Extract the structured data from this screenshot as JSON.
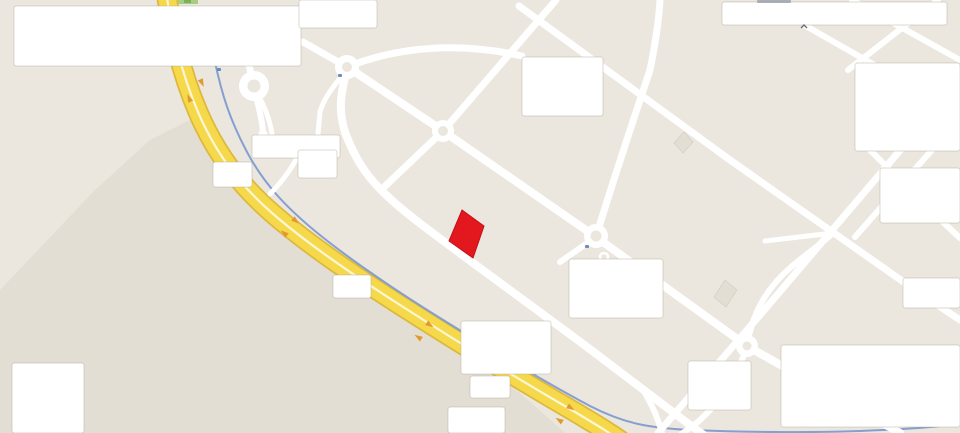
{
  "map": {
    "kind": "road-map-with-redacted-labels",
    "canvas": {
      "width": 960,
      "height": 433
    },
    "colors": {
      "background": "#ebe7de",
      "shade_zone": "rgba(208,201,186,0.30)",
      "road_white": "#ffffff",
      "highway_casing": "#dcb83e",
      "highway_fill": "#f6d94a",
      "highway_divider": "#fdf6d8",
      "arrow_orange": "#e2992f",
      "waterway_blue": "#7f9bd0",
      "building_red": "#e3171e",
      "building_red_stroke": "#c31016",
      "building_gray": "#e2ded4",
      "box_fill": "#ffffff",
      "box_edge": "rgba(175,168,150,0.45)",
      "poi_blue": "#5b7fbe",
      "fragment_green": "#a9cd80",
      "fragment_green_dark": "#7fae5d",
      "fragment_gray": "#9aa0ab"
    },
    "shade_polygon": "190,120 230,175 275,220 330,263 390,303 455,348 520,393 565,433 0,433 0,290 95,190 150,140",
    "highway": {
      "path": "M 166,-8 C 172,30 180,70 198,112 C 216,154 240,185 272,213 C 304,241 350,273 400,305 C 450,337 520,380 575,412 C 600,427 615,436 628,446",
      "casing_width": 21,
      "fill_width": 17.5,
      "divider_width": 2.2,
      "arrows": [
        {
          "x": 189,
          "y": 98,
          "angle": 246
        },
        {
          "x": 202,
          "y": 83,
          "angle": 66
        },
        {
          "x": 284,
          "y": 233,
          "angle": 220
        },
        {
          "x": 296,
          "y": 221,
          "angle": 40
        },
        {
          "x": 418,
          "y": 337,
          "angle": 213
        },
        {
          "x": 430,
          "y": 325,
          "angle": 33
        },
        {
          "x": 559,
          "y": 420,
          "angle": 213
        },
        {
          "x": 571,
          "y": 408,
          "angle": 33
        }
      ]
    },
    "waterway": {
      "path": "M 215,62 C 222,95 230,120 247,152 C 264,184 286,207 315,231 C 344,255 390,287 440,318 C 490,349 545,382 590,406 C 625,424 650,428 690,430 C 740,432 800,433 860,431 C 910,429 940,427 962,423",
      "width": 2
    },
    "roads": [
      {
        "id": "frontage",
        "width": 8,
        "d": "M 347,70 C 340,95 338,112 346,135 C 356,160 366,175 382,191 C 402,211 430,231 465,257 C 500,283 540,312 575,338 C 610,364 650,395 690,425 C 700,432 706,437 712,441"
      },
      {
        "id": "frontage-spur",
        "width": 6,
        "d": "M 645,393 C 652,405 658,418 662,433"
      },
      {
        "id": "avenue-b-c-d-e",
        "width": 8,
        "d": "M 349,68 L 443,131 L 596,237 L 747,346 L 900,433"
      },
      {
        "id": "cross-through-c",
        "width": 7,
        "d": "M 556,0 L 443,131 L 381,190"
      },
      {
        "id": "avenue-upper",
        "width": 7,
        "d": "M 519,6 L 730,160 L 915,290 L 960,320"
      },
      {
        "id": "cross-right-long",
        "width": 7,
        "d": "M 902,148 L 760,315 L 658,433"
      },
      {
        "id": "d-north",
        "width": 7,
        "d": "M 596,237 C 610,190 630,130 650,70 C 656,40 659,20 660,0"
      },
      {
        "id": "e-north",
        "width": 6,
        "d": "M 747,346 C 752,315 765,290 790,268 C 805,255 820,245 833,233"
      },
      {
        "id": "e-southwest",
        "width": 6,
        "d": "M 747,346 C 738,375 720,402 700,420 C 690,429 680,435 672,440"
      },
      {
        "id": "d-west-link",
        "width": 5,
        "d": "M 765,241 L 833,233"
      },
      {
        "id": "d-southwest-stub",
        "width": 6,
        "d": "M 596,237 L 560,262"
      },
      {
        "id": "a-north",
        "width": 7,
        "d": "M 254,88 L 248,60"
      },
      {
        "id": "a-south-stub",
        "width": 6,
        "d": "M 254,88 C 258,105 262,118 263,133"
      },
      {
        "id": "a-southeast",
        "width": 5,
        "d": "M 257,93 C 265,107 270,120 272,134"
      },
      {
        "id": "b-southwest",
        "width": 5,
        "d": "M 345,72 C 332,88 323,100 320,112 L 318,134"
      },
      {
        "id": "ramp",
        "width": 5,
        "d": "M 296,160 C 289,172 281,183 270,194"
      },
      {
        "id": "b-northwest",
        "width": 7,
        "d": "M 347,67 L 303,42"
      },
      {
        "id": "b-northeast",
        "width": 7,
        "d": "M 347,67 C 400,46 460,42 522,56"
      },
      {
        "id": "ne-lattice-1",
        "width": 6,
        "d": "M 806,26 L 960,114"
      },
      {
        "id": "ne-lattice-2",
        "width": 6,
        "d": "M 852,0 L 960,60"
      },
      {
        "id": "ne-lattice-3",
        "width": 6,
        "d": "M 938,0 L 848,70"
      },
      {
        "id": "se-lattice-1",
        "width": 6,
        "d": "M 870,150 L 932,212 L 960,238"
      },
      {
        "id": "se-lattice-2",
        "width": 6,
        "d": "M 932,150 L 884,204 L 855,237"
      }
    ],
    "roundabouts": [
      {
        "id": "roundabout-a",
        "cx": 254,
        "cy": 86,
        "r": 15,
        "hole": 6.5
      },
      {
        "id": "roundabout-b",
        "cx": 347,
        "cy": 67,
        "r": 12,
        "hole": 5
      },
      {
        "id": "roundabout-c",
        "cx": 443,
        "cy": 131,
        "r": 11,
        "hole": 5
      },
      {
        "id": "roundabout-d",
        "cx": 596,
        "cy": 236,
        "r": 12,
        "hole": 5.5
      },
      {
        "id": "roundabout-e",
        "cx": 747,
        "cy": 346,
        "r": 11,
        "hole": 4.5
      }
    ],
    "stub_caps": [
      {
        "cx": 263,
        "cy": 134,
        "r": 4.5
      }
    ],
    "poi_ring": {
      "cx": 604,
      "cy": 257,
      "r": 4
    },
    "buildings": {
      "highlighted": {
        "points": "462,210 484,226 473,258 449,241",
        "label": "selected-building"
      },
      "gray": [
        {
          "points": "684,132 693,142 683,153 674,143"
        },
        {
          "points": "725,280 737,290 726,307 714,297"
        }
      ]
    },
    "redaction_boxes": [
      {
        "x": 14,
        "y": 6,
        "w": 287,
        "h": 60
      },
      {
        "x": 299,
        "y": 0,
        "w": 78,
        "h": 28
      },
      {
        "x": 722,
        "y": 2,
        "w": 225,
        "h": 23
      },
      {
        "x": 522,
        "y": 57,
        "w": 81,
        "h": 59
      },
      {
        "x": 855,
        "y": 63,
        "w": 105,
        "h": 88
      },
      {
        "x": 880,
        "y": 168,
        "w": 80,
        "h": 55
      },
      {
        "x": 252,
        "y": 135,
        "w": 88,
        "h": 23
      },
      {
        "x": 298,
        "y": 150,
        "w": 39,
        "h": 28
      },
      {
        "x": 213,
        "y": 162,
        "w": 39,
        "h": 25
      },
      {
        "x": 333,
        "y": 275,
        "w": 38,
        "h": 23
      },
      {
        "x": 461,
        "y": 321,
        "w": 90,
        "h": 53
      },
      {
        "x": 470,
        "y": 376,
        "w": 40,
        "h": 22
      },
      {
        "x": 448,
        "y": 407,
        "w": 57,
        "h": 26
      },
      {
        "x": 569,
        "y": 259,
        "w": 94,
        "h": 59
      },
      {
        "x": 688,
        "y": 361,
        "w": 63,
        "h": 49
      },
      {
        "x": 781,
        "y": 345,
        "w": 179,
        "h": 82
      },
      {
        "x": 903,
        "y": 278,
        "w": 57,
        "h": 30
      },
      {
        "x": 12,
        "y": 363,
        "w": 72,
        "h": 70
      }
    ],
    "blue_dots": [
      {
        "x": 585,
        "y": 245
      },
      {
        "x": 338,
        "y": 74
      },
      {
        "x": 217,
        "y": 68
      }
    ],
    "edge_fragments": {
      "green_sliver": {
        "x": 178,
        "y": 0,
        "w": 20,
        "h": 4
      },
      "green_dot": {
        "x": 184,
        "y": 0,
        "w": 7,
        "h": 3
      },
      "text_smudge": {
        "x": 757,
        "y": 0,
        "w": 34,
        "h": 3
      },
      "caret_mark": {
        "x": 801,
        "y": 25,
        "w": 6,
        "h": 4
      }
    }
  }
}
